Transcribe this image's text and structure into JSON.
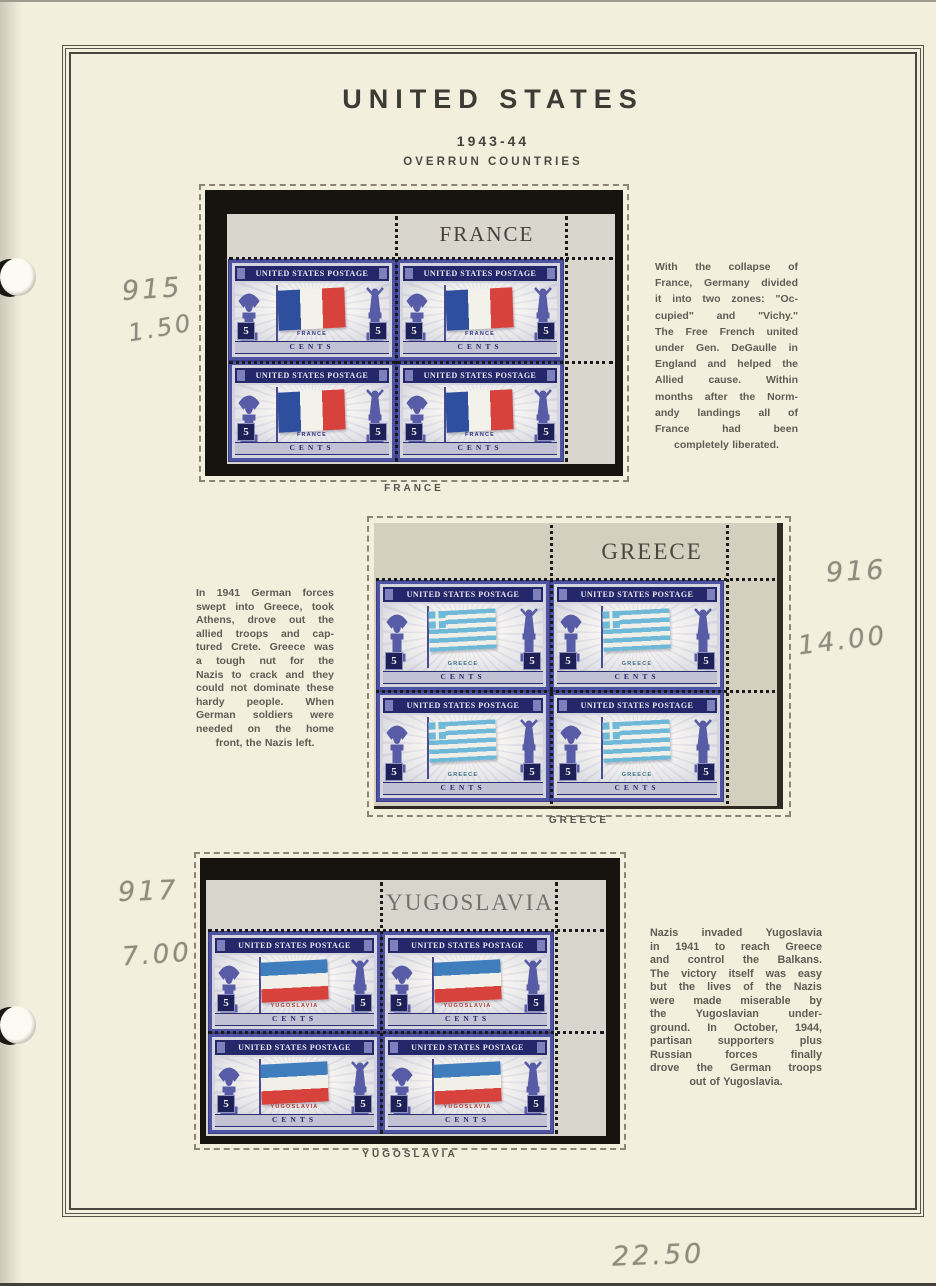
{
  "page": {
    "title": "UNITED STATES",
    "year": "1943-44",
    "series": "OVERRUN COUNTRIES",
    "handwritten_total": "22.50"
  },
  "stamp_common": {
    "header": "UNITED STATES POSTAGE",
    "denomination": "5",
    "denomination_word": "CENTS"
  },
  "colors": {
    "page_background": "#f3efdd",
    "stamp_frame": "#4e52a2",
    "stamp_band": "#24276a",
    "pencil": "#8f8b7e",
    "description_ink": "#5e5c54",
    "title_ink": "#3c3b36"
  },
  "blocks": [
    {
      "name": "France",
      "selvage_label": "FRANCE",
      "caption": "FRANCE",
      "stamp_country": "FRANCE",
      "stamp_country_color": "#31348a",
      "flag": {
        "layout": "vertical",
        "colors": [
          "#2d4f9e",
          "#f2f1ea",
          "#d8423c"
        ]
      },
      "handwritten_catalog": "915",
      "handwritten_price": "1.50",
      "description_lines": [
        "With the collapse of",
        "France, Germany divided",
        "it into two zones: \"Oc-",
        "cupied\" and \"Vichy.\"",
        "The Free French united",
        "under Gen. DeGaulle in",
        "England and helped the",
        "Allied cause. Within",
        "months after the Norm-",
        "andy landings all of",
        "France had been",
        "completely liberated."
      ]
    },
    {
      "name": "Greece",
      "selvage_label": "GREECE",
      "caption": "GREECE",
      "stamp_country": "GREECE",
      "stamp_country_color": "#3a6e84",
      "flag": {
        "layout": "greece",
        "colors": [
          "#6fb9d8",
          "#f0efe8"
        ]
      },
      "handwritten_catalog": "916",
      "handwritten_price": "14.00",
      "description_lines": [
        "In 1941 German forces",
        "swept into Greece, took",
        "Athens, drove out the",
        "allied troops and cap-",
        "tured Crete. Greece was",
        "a tough nut for the",
        "Nazis to crack and they",
        "could not dominate these",
        "hardy people. When",
        "German soldiers were",
        "needed on the home",
        "front, the Nazis left."
      ]
    },
    {
      "name": "Yugoslavia",
      "selvage_label": "YUGOSLAVIA",
      "caption": "YUGOSLAVIA",
      "stamp_country": "YUGOSLAVIA",
      "stamp_country_color": "#b03a34",
      "flag": {
        "layout": "horizontal",
        "colors": [
          "#3f7dbd",
          "#f0efe8",
          "#d8423c"
        ]
      },
      "handwritten_catalog": "917",
      "handwritten_price": "7.00",
      "description_lines": [
        "Nazis invaded Yugoslavia",
        "in 1941 to reach Greece",
        "and control the Balkans.",
        "The victory itself was easy",
        "but the lives of the Nazis",
        "were made miserable by",
        "the Yugoslavian under-",
        "ground. In October, 1944,",
        "partisan supporters plus",
        "Russian forces finally",
        "drove the German troops",
        "out of Yugoslavia."
      ]
    }
  ]
}
